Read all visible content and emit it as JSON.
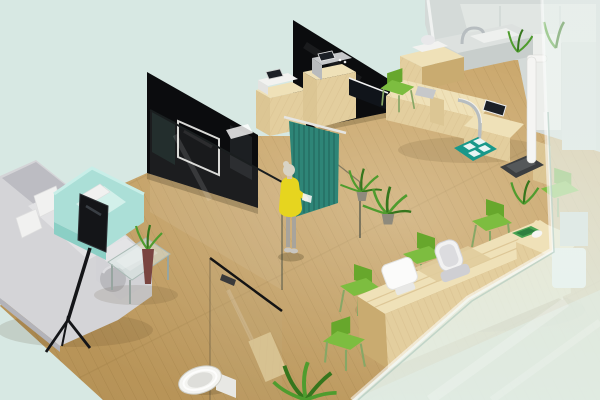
{
  "scene": {
    "type": "isometric-3d-interior-render",
    "description": "Isometric 3D rendering of a clinic office interior: waiting lounge with grey sectional sofa and mint armchair, glass partition walls, teal privacy curtain with a woman in a yellow dress, wooden examination workstation with instruments and stadiometer, restroom with toilet behind a glass door, and a long wooden reception counter with green chairs, seen through a frosted glass facade",
    "rooms": [
      "waiting-lounge",
      "consultation-area",
      "examination-area",
      "reception",
      "restroom"
    ],
    "objects": [
      "grey L-shaped sectional sofa with white cushions",
      "mint green armchair with pillow",
      "flat screen TV on black tripod floor stand",
      "glass coffee table",
      "maroon vase with green plant on table",
      "dark glass partition wall with wall-mounted TV",
      "tall dark glass partition wall",
      "clear glass partition panes",
      "wooden cabinet with white printer",
      "wooden cabinet with grey medical device",
      "black work counter",
      "teal privacy curtain on rail",
      "woman in yellow dress holding a paper",
      "two potted floor plants",
      "wooden examination workstation with instruments and monitor",
      "chrome support arc",
      "green side chair at examination desk",
      "teal floor mat with white pads",
      "white stadiometer height rod",
      "dark weighing scale platform",
      "grey sink counter with gooseneck faucet",
      "white and grey wall panels",
      "long wooden reception counter with rounded ends",
      "white monitor on reception counter",
      "grey office chair",
      "four green waiting chairs",
      "green desk tray and white computer mouse",
      "glass restroom door with dark handle",
      "white toilet",
      "small wooden storage cabinet",
      "floor plant at bottom edge",
      "plants and furniture silhouettes behind frosted glass",
      "wood plank flooring",
      "pale mint background"
    ]
  },
  "colors": {
    "bg": "#d7e8e3",
    "floor": "#c7a263",
    "floorLine": "#a8854a",
    "woodLight": "#efe1b8",
    "woodStripe": "#d9c190",
    "woodSide": "#e3ce9e",
    "woodDark": "#c9ab70",
    "cabinet": "#dcc694",
    "wallDark": "#0b0c0e",
    "glassEdge": "#1a1e1f",
    "curtain": "#2e8577",
    "curtainDark": "#22675c",
    "dress": "#e6d51f",
    "hair": "#d8d3c4",
    "skin": "#d8c4ad",
    "legs": "#a8a49c",
    "plant": "#4f9c2e",
    "plantDark": "#36761d",
    "pot": "#8e8a7c",
    "sofa": "#d4d4d7",
    "sofaDark": "#bcbcc2",
    "pillow": "#f1f1f0",
    "armchair": "#abdfd7",
    "armchairDark": "#8bcfc5",
    "chairGreen": "#67a72c",
    "chairGreenLight": "#7dbd40",
    "chairLeg": "#87a765",
    "deviceWhite": "#f2f2f0",
    "deviceGray": "#c6c8ca",
    "screenDark": "#1c2026",
    "matTeal": "#18988a",
    "chrome": "#b7bdc0",
    "toilet": "#f4f4f1",
    "grayWall": "#d4dad8",
    "grayWallLight": "#e3e8e6",
    "frost": "#ecf5f1",
    "standBlack": "#141518",
    "vase": "#7a4540",
    "scaleDark": "#3c3e40",
    "stadiometer": "#f5f5f3"
  }
}
